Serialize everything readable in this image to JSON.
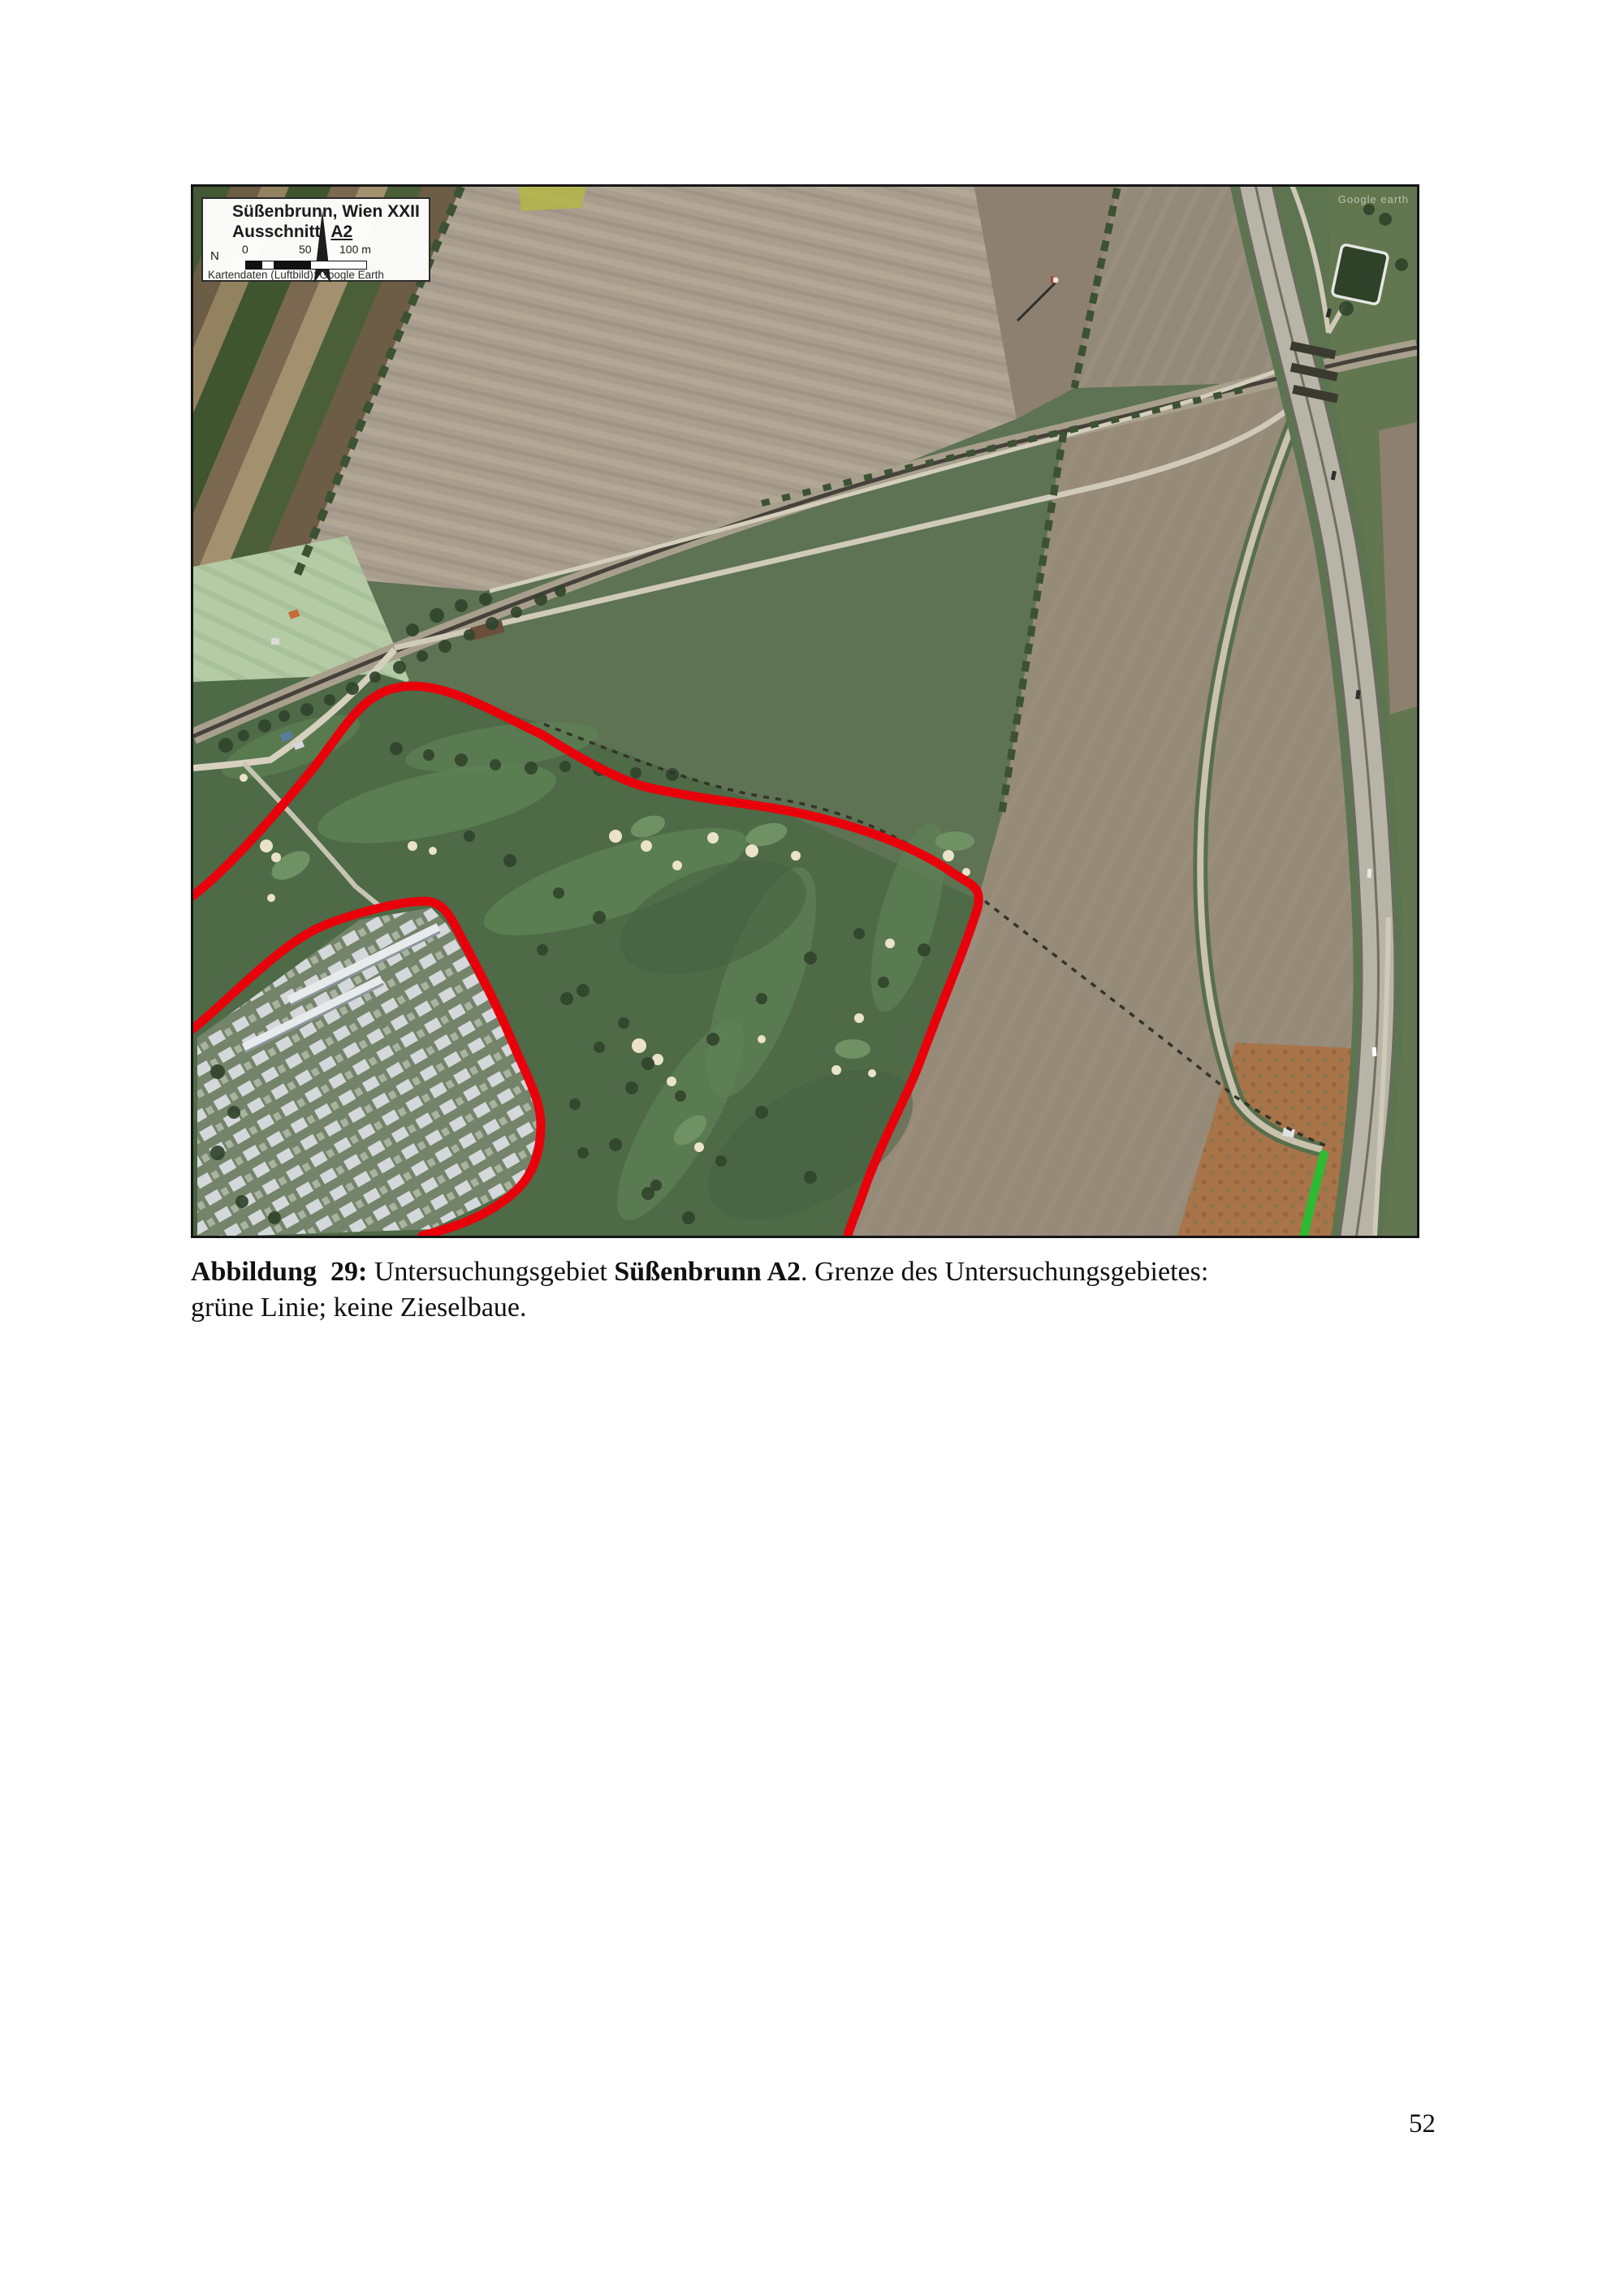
{
  "page": {
    "number": "52"
  },
  "figure": {
    "map": {
      "legend": {
        "title": "Süßenbrunn, Wien XXII",
        "subtitle_label": "Ausschnitt:",
        "subtitle_value": "A2",
        "north_label": "N",
        "scale_ticks": [
          "0",
          "50",
          "100 m"
        ],
        "source_credit": "Kartendaten (Luftbild): Google Earth"
      },
      "watermark": "Google earth",
      "red_line_color": "#e8000b",
      "green_line_color": "#2fba34"
    },
    "caption": {
      "label": "Abbildung  29:",
      "text_after_label": " Untersuchungsgebiet ",
      "site_bold": "Süßenbrunn A2",
      "text_middle": ". Grenze des Untersuchungsgebietes:",
      "line2": "grüne Linie; keine Zieselbaue."
    }
  }
}
